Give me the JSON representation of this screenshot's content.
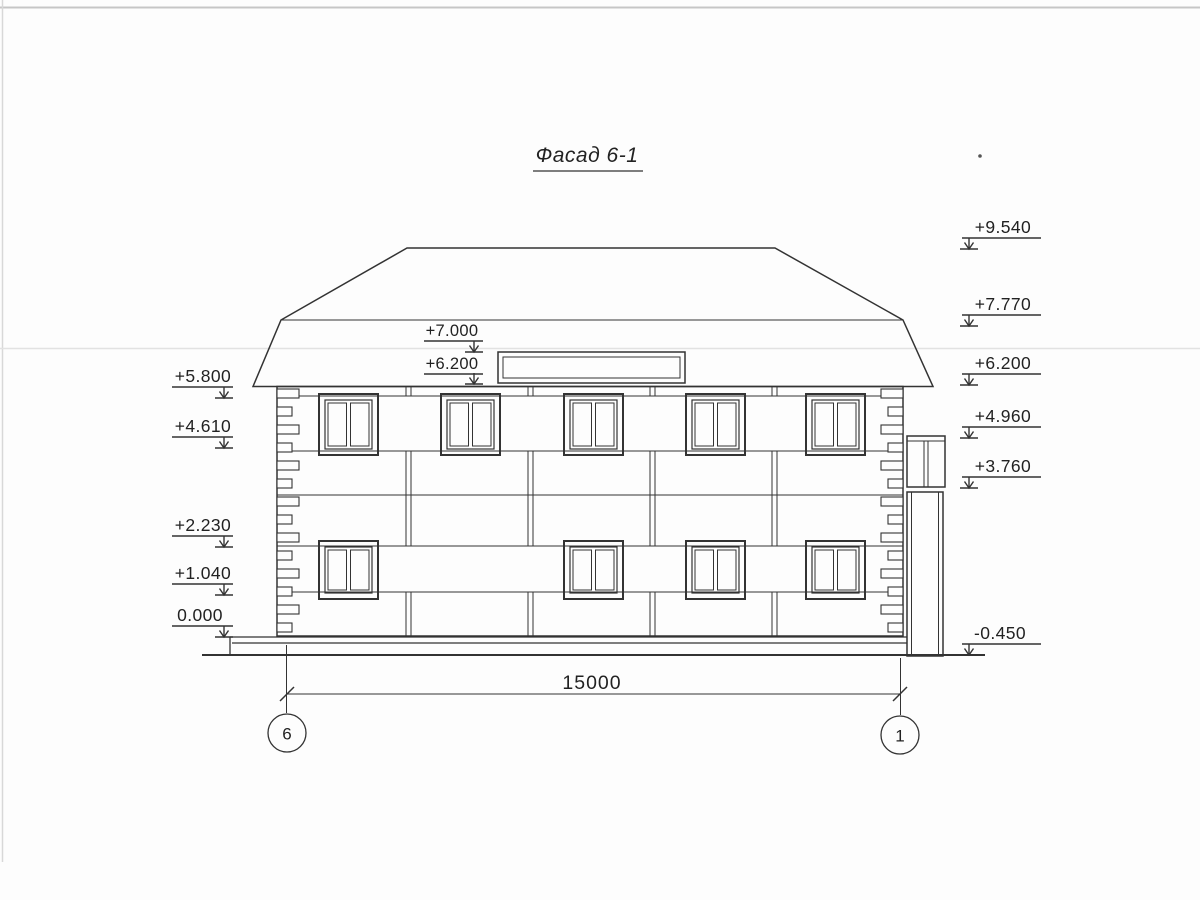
{
  "title": "Фасад 6-1",
  "marks": {
    "left": [
      "+5.800",
      "+4.610",
      "+2.230",
      "+1.040",
      "0.000"
    ],
    "right": [
      "+9.540",
      "+7.770",
      "+6.200",
      "+4.960",
      "+3.760",
      "-0.450"
    ],
    "roof": [
      "+7.000",
      "+6.200"
    ]
  },
  "dimension_label": "15000",
  "axis_left": "6",
  "axis_right": "1",
  "colors": {
    "ink": "#333333",
    "paper": "#fdfdfd",
    "scan_artifact": "#dedede"
  }
}
